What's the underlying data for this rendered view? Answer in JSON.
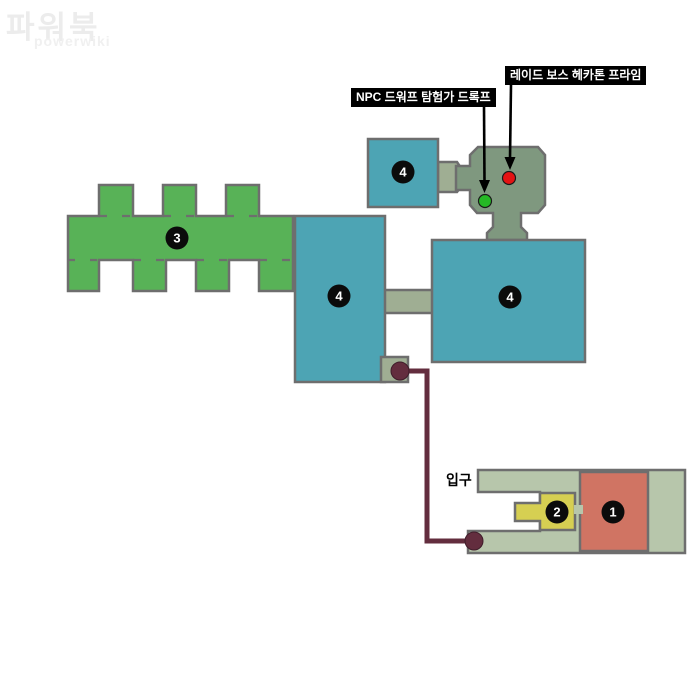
{
  "watermark": {
    "title": "파워북",
    "subtitle": "powerwiki"
  },
  "entrance_label": "입구",
  "markers": [
    {
      "id": "raid-boss-hecaton-prime",
      "label": "레이드 보스 헤카톤 프라임",
      "color": "#e31313"
    },
    {
      "id": "npc-dwarf-explorer-drokf",
      "label": "NPC 드워프 탐험가 드록프",
      "color": "#25b825"
    }
  ],
  "areas": [
    {
      "number": "1",
      "name": "area-1-entrance-hall",
      "color": "#d07463"
    },
    {
      "number": "2",
      "name": "area-2-side-room",
      "color": "#d6cf52"
    },
    {
      "number": "3",
      "name": "area-3-comb-halls",
      "color": "#58b257"
    },
    {
      "number": "4",
      "name": "area-4-left-hall",
      "color": "#4da4b4"
    },
    {
      "number": "4",
      "name": "area-4-right-hall",
      "color": "#4da4b4"
    },
    {
      "number": "4",
      "name": "area-4-top-room",
      "color": "#4da4b4"
    }
  ],
  "map_colors": {
    "corridor": "#9fae93",
    "boss_room": "#7f987f",
    "entrance": "#b7c6ab",
    "border": "#6e6e6e"
  },
  "route": {
    "color": "#632d3e"
  }
}
